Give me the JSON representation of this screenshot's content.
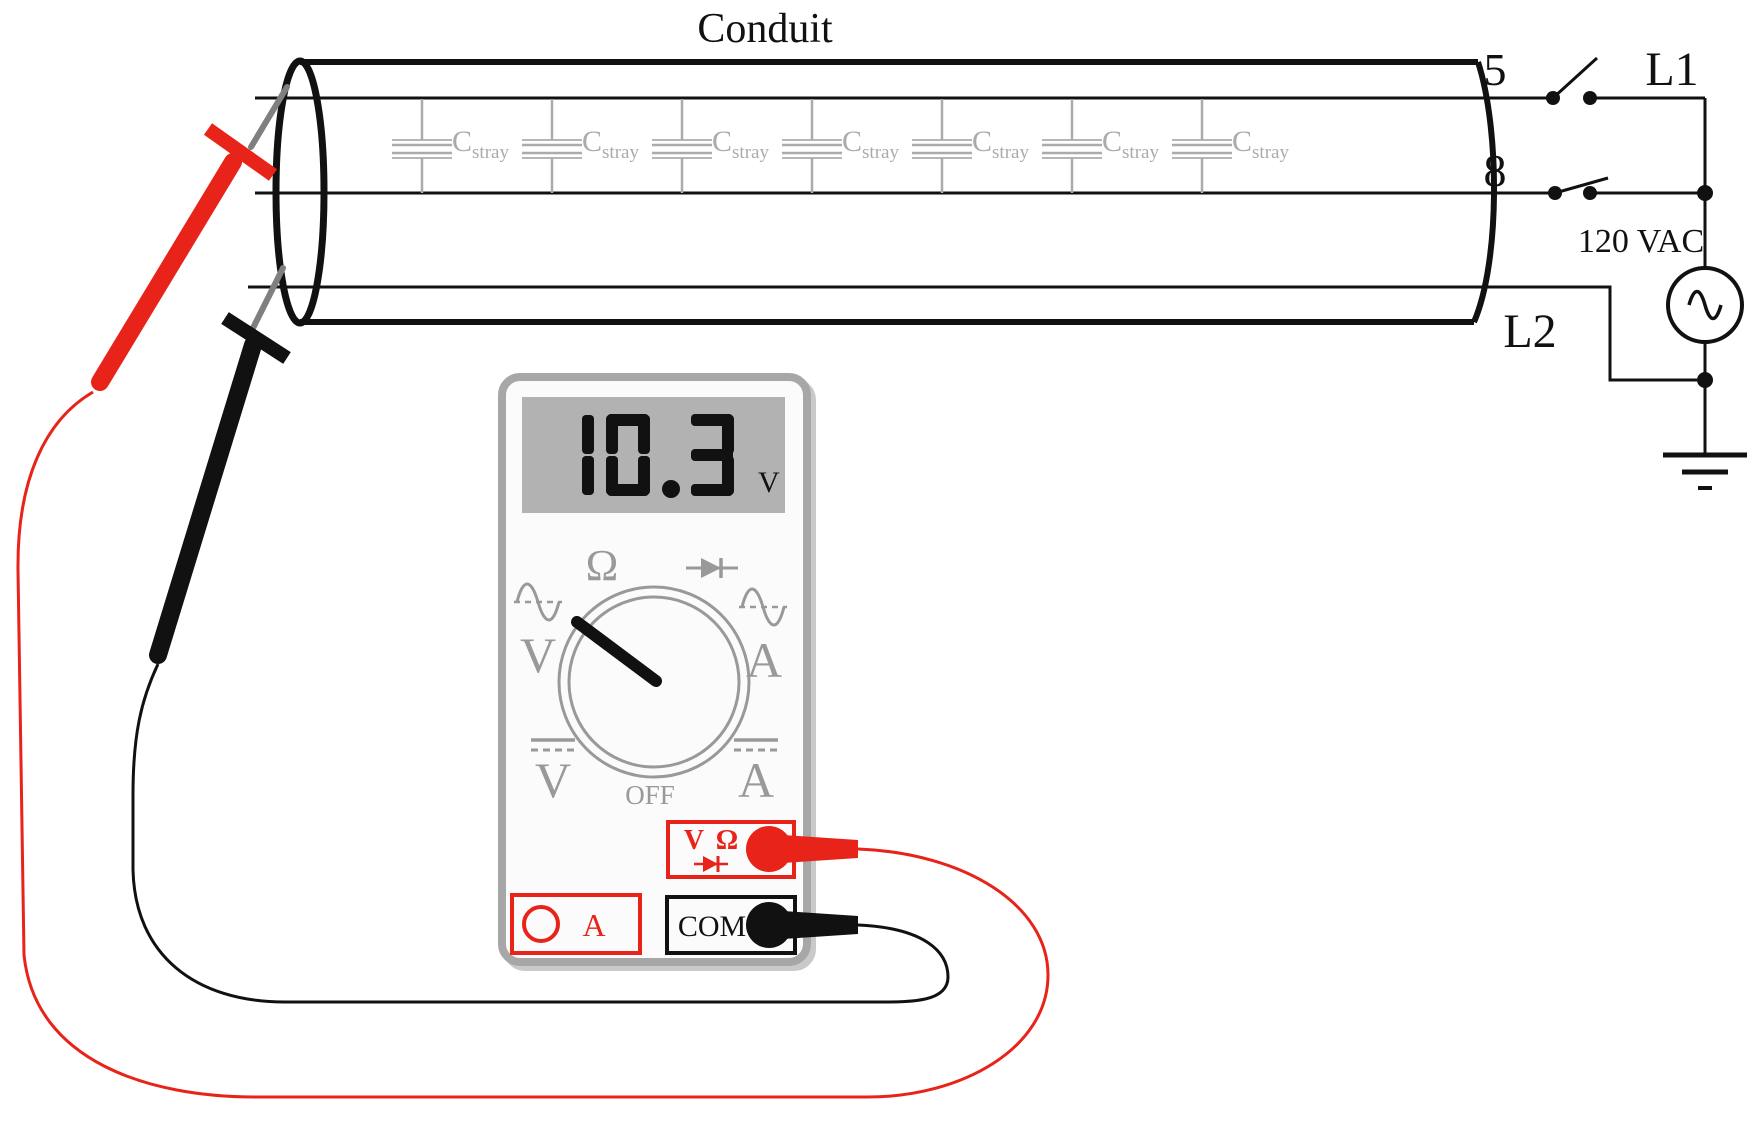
{
  "colors": {
    "red": "#e82319",
    "dial_gray": "#999999",
    "cap_label_gray": "#ababab",
    "display_bg": "#b2b2b2",
    "meter_frame_gray": "#a7a7a7",
    "ink": "#111111",
    "probe_needle_gray": "#7f7f7f"
  },
  "conduit": {
    "title": "Conduit",
    "cap": {
      "count": 7,
      "symbol": "C",
      "subscript": "stray"
    }
  },
  "circuit": {
    "wire5_label": "5",
    "wire8_label": "8",
    "l1_label": "L1",
    "l2_label": "L2",
    "source_label": "120 VAC"
  },
  "meter": {
    "display": {
      "value": "10.3",
      "unit": "V"
    },
    "dial": {
      "ohms": "Ω",
      "off": "OFF",
      "ac_volts": "V",
      "ac_amps": "A",
      "dc_volts": "V",
      "dc_amps": "A"
    },
    "jacks": {
      "vo_v": "V",
      "vo_ohm": "Ω",
      "com": "COM",
      "amps": "A"
    }
  }
}
